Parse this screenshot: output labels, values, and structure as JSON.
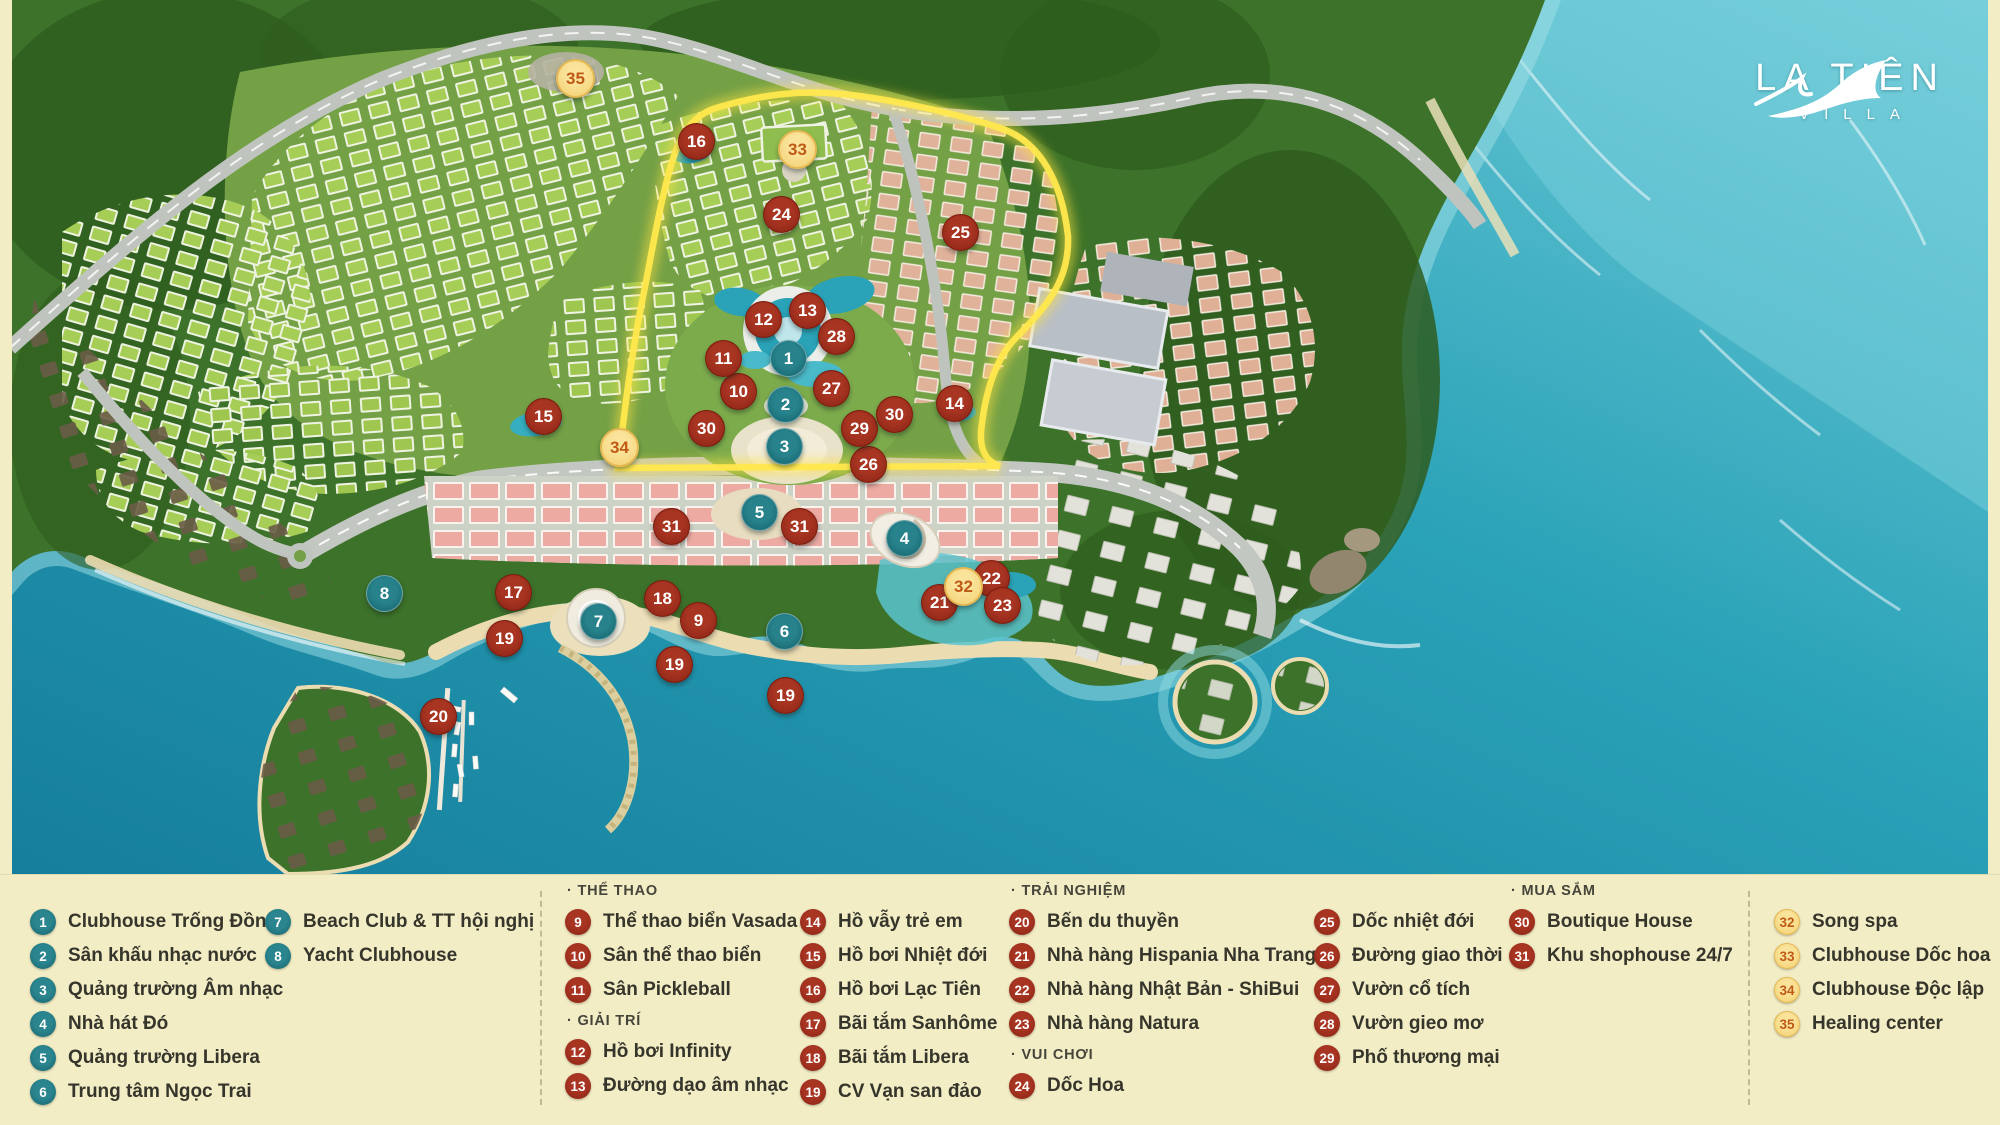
{
  "logo": {
    "brand": "LA TIÊN",
    "brand_sub": "VILLA"
  },
  "colors": {
    "legend_bg": "#f3edc6",
    "legend_text": "#35352b",
    "marker_teal": "#1d6f78",
    "marker_red": "#97291b",
    "marker_yellow_bg": "#f6d77d",
    "marker_yellow_text": "#bf5a15",
    "boundary_yellow": "#ffe84d",
    "ocean": "#2196b1"
  },
  "map": {
    "markers": [
      {
        "n": "1",
        "c": "teal",
        "x": 787,
        "y": 357
      },
      {
        "n": "2",
        "c": "teal",
        "x": 784,
        "y": 403
      },
      {
        "n": "3",
        "c": "teal",
        "x": 783,
        "y": 445
      },
      {
        "n": "4",
        "c": "teal",
        "x": 903,
        "y": 537
      },
      {
        "n": "5",
        "c": "teal",
        "x": 758,
        "y": 511
      },
      {
        "n": "6",
        "c": "teal",
        "x": 783,
        "y": 630
      },
      {
        "n": "7",
        "c": "teal",
        "x": 597,
        "y": 620
      },
      {
        "n": "8",
        "c": "teal",
        "x": 383,
        "y": 592
      },
      {
        "n": "9",
        "c": "red",
        "x": 697,
        "y": 619
      },
      {
        "n": "10",
        "c": "red",
        "x": 737,
        "y": 390
      },
      {
        "n": "11",
        "c": "red",
        "x": 722,
        "y": 357
      },
      {
        "n": "12",
        "c": "red",
        "x": 762,
        "y": 318
      },
      {
        "n": "13",
        "c": "red",
        "x": 806,
        "y": 309
      },
      {
        "n": "14",
        "c": "red",
        "x": 953,
        "y": 402
      },
      {
        "n": "15",
        "c": "red",
        "x": 542,
        "y": 415
      },
      {
        "n": "16",
        "c": "red",
        "x": 695,
        "y": 140
      },
      {
        "n": "17",
        "c": "red",
        "x": 512,
        "y": 591
      },
      {
        "n": "18",
        "c": "red",
        "x": 661,
        "y": 597
      },
      {
        "n": "19",
        "c": "red",
        "x": 503,
        "y": 637
      },
      {
        "n": "19",
        "c": "red",
        "x": 673,
        "y": 663
      },
      {
        "n": "19",
        "c": "red",
        "x": 784,
        "y": 694
      },
      {
        "n": "20",
        "c": "red",
        "x": 437,
        "y": 715
      },
      {
        "n": "21",
        "c": "red",
        "x": 938,
        "y": 601
      },
      {
        "n": "22",
        "c": "red",
        "x": 990,
        "y": 577
      },
      {
        "n": "23",
        "c": "red",
        "x": 1001,
        "y": 604
      },
      {
        "n": "24",
        "c": "red",
        "x": 780,
        "y": 213
      },
      {
        "n": "25",
        "c": "red",
        "x": 959,
        "y": 231
      },
      {
        "n": "26",
        "c": "red",
        "x": 867,
        "y": 463
      },
      {
        "n": "27",
        "c": "red",
        "x": 830,
        "y": 387
      },
      {
        "n": "28",
        "c": "red",
        "x": 835,
        "y": 335
      },
      {
        "n": "29",
        "c": "red",
        "x": 858,
        "y": 427
      },
      {
        "n": "30",
        "c": "red",
        "x": 705,
        "y": 427
      },
      {
        "n": "30",
        "c": "red",
        "x": 893,
        "y": 413
      },
      {
        "n": "31",
        "c": "red",
        "x": 670,
        "y": 525
      },
      {
        "n": "31",
        "c": "red",
        "x": 798,
        "y": 525
      },
      {
        "n": "32",
        "c": "yellow",
        "x": 961,
        "y": 584
      },
      {
        "n": "33",
        "c": "yellow",
        "x": 795,
        "y": 147
      },
      {
        "n": "34",
        "c": "yellow",
        "x": 617,
        "y": 445
      },
      {
        "n": "35",
        "c": "yellow",
        "x": 573,
        "y": 76
      }
    ]
  },
  "legend": {
    "separators_x": [
      540,
      1748
    ],
    "columns": [
      {
        "x": 30,
        "entries": [
          {
            "n": "1",
            "c": "teal",
            "t": "Clubhouse Trống Đồng"
          },
          {
            "n": "2",
            "c": "teal",
            "t": "Sân khấu nhạc nước"
          },
          {
            "n": "3",
            "c": "teal",
            "t": "Quảng trường Âm nhạc"
          },
          {
            "n": "4",
            "c": "teal",
            "t": "Nhà hát Đó"
          },
          {
            "n": "5",
            "c": "teal",
            "t": "Quảng trường Libera"
          },
          {
            "n": "6",
            "c": "teal",
            "t": "Trung tâm Ngọc Trai"
          }
        ]
      },
      {
        "x": 265,
        "entries": [
          {
            "n": "7",
            "c": "teal",
            "t": "Beach Club & TT hội nghị"
          },
          {
            "n": "8",
            "c": "teal",
            "t": "Yacht Clubhouse"
          }
        ]
      },
      {
        "x": 565,
        "entries": [
          {
            "h": "· THỂ THAO"
          },
          {
            "n": "9",
            "c": "red",
            "t": "Thể thao biển Vasada"
          },
          {
            "n": "10",
            "c": "red",
            "t": "Sân thể thao biển"
          },
          {
            "n": "11",
            "c": "red",
            "t": "Sân Pickleball"
          },
          {
            "h": "· GIẢI TRÍ"
          },
          {
            "n": "12",
            "c": "red",
            "t": "Hồ bơi Infinity"
          },
          {
            "n": "13",
            "c": "red",
            "t": "Đường dạo âm nhạc"
          }
        ]
      },
      {
        "x": 800,
        "entries": [
          {
            "n": "14",
            "c": "red",
            "t": "Hồ vẫy trẻ em"
          },
          {
            "n": "15",
            "c": "red",
            "t": "Hồ bơi Nhiệt đới"
          },
          {
            "n": "16",
            "c": "red",
            "t": "Hồ bơi Lạc Tiên"
          },
          {
            "n": "17",
            "c": "red",
            "t": "Bãi tắm Sanhôme"
          },
          {
            "n": "18",
            "c": "red",
            "t": "Bãi tắm Libera"
          },
          {
            "n": "19",
            "c": "red",
            "t": "CV Vạn san đảo"
          }
        ]
      },
      {
        "x": 1009,
        "entries": [
          {
            "h": "· TRẢI NGHIỆM"
          },
          {
            "n": "20",
            "c": "red",
            "t": "Bến du thuyền"
          },
          {
            "n": "21",
            "c": "red",
            "t": "Nhà hàng Hispania Nha Trang"
          },
          {
            "n": "22",
            "c": "red",
            "t": "Nhà hàng Nhật Bản - ShiBui"
          },
          {
            "n": "23",
            "c": "red",
            "t": "Nhà hàng Natura"
          },
          {
            "h": "· VUI CHƠI"
          },
          {
            "n": "24",
            "c": "red",
            "t": "Dốc Hoa"
          }
        ]
      },
      {
        "x": 1314,
        "entries": [
          {
            "n": "25",
            "c": "red",
            "t": "Dốc nhiệt đới"
          },
          {
            "n": "26",
            "c": "red",
            "t": "Đường giao thời"
          },
          {
            "n": "27",
            "c": "red",
            "t": "Vườn cổ tích"
          },
          {
            "n": "28",
            "c": "red",
            "t": "Vườn gieo mơ"
          },
          {
            "n": "29",
            "c": "red",
            "t": "Phố thương mại"
          }
        ]
      },
      {
        "x": 1509,
        "entries": [
          {
            "h": "· MUA SẮM"
          },
          {
            "n": "30",
            "c": "red",
            "t": "Boutique House"
          },
          {
            "n": "31",
            "c": "red",
            "t": "Khu shophouse 24/7"
          }
        ]
      },
      {
        "x": 1774,
        "entries": [
          {
            "n": "32",
            "c": "yellow",
            "t": "Song spa"
          },
          {
            "n": "33",
            "c": "yellow",
            "t": "Clubhouse Dốc hoa"
          },
          {
            "n": "34",
            "c": "yellow",
            "t": "Clubhouse Độc lập"
          },
          {
            "n": "35",
            "c": "yellow",
            "t": "Healing center"
          }
        ]
      }
    ]
  }
}
